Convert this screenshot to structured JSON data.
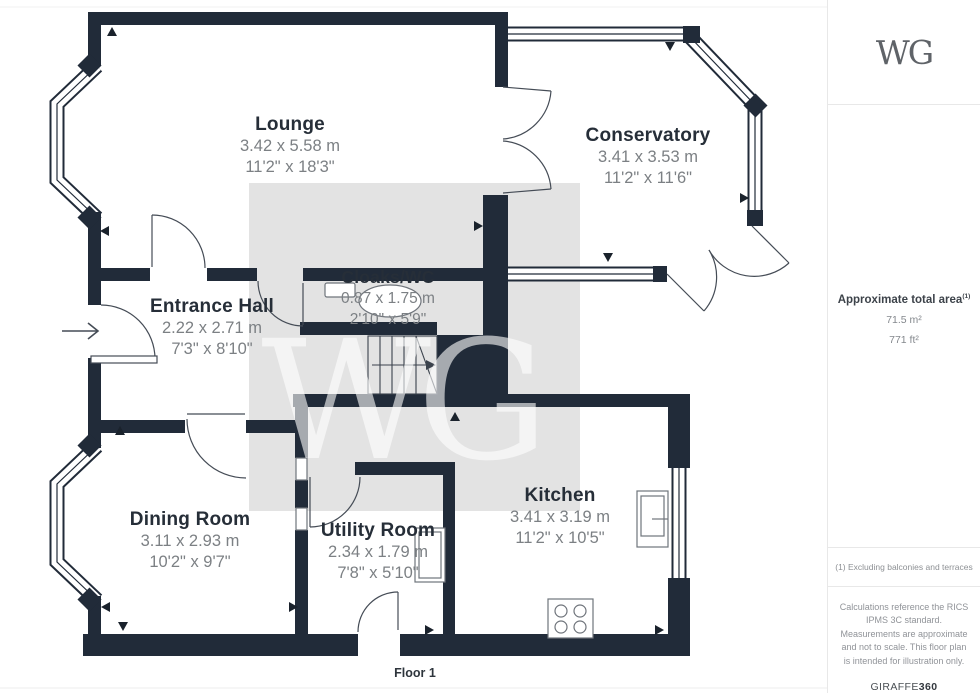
{
  "watermark": {
    "text": "WG"
  },
  "floor_label": "Floor 1",
  "rooms": [
    {
      "name": "Lounge",
      "metric": "3.42 x 5.58 m",
      "imperial": "11'2\" x 18'3\""
    },
    {
      "name": "Conservatory",
      "metric": "3.41 x 3.53 m",
      "imperial": "11'2\" x 11'6\""
    },
    {
      "name": "Entrance Hall",
      "metric": "2.22 x 2.71 m",
      "imperial": "7'3\" x 8'10\""
    },
    {
      "name": "Cloaks/WC",
      "metric": "0.87 x 1.75 m",
      "imperial": "2'10\" x 5'9\""
    },
    {
      "name": "Dining Room",
      "metric": "3.11 x 2.93 m",
      "imperial": "10'2\" x 9'7\""
    },
    {
      "name": "Utility Room",
      "metric": "2.34 x 1.79 m",
      "imperial": "7'8\" x 5'10\""
    },
    {
      "name": "Kitchen",
      "metric": "3.41 x 3.19 m",
      "imperial": "11'2\" x 10'5\""
    }
  ],
  "sidebar": {
    "logo": "WG",
    "area_title": "Approximate total area",
    "area_superscript": "(1)",
    "area_m2": "71.5 m²",
    "area_ft2": "771 ft²",
    "note": "(1) Excluding balconies and terraces",
    "disclaimer": "Calculations reference the RICS IPMS 3C standard. Measurements are approximate and not to scale. This floor plan is intended for illustration only.",
    "brand_name": "GIRAFFE",
    "brand_number": "360"
  },
  "colors": {
    "wall": "#212b39",
    "watermark_bg": "#e3e3e3",
    "room_text": "#262e38",
    "dim_text": "#7c8084"
  }
}
